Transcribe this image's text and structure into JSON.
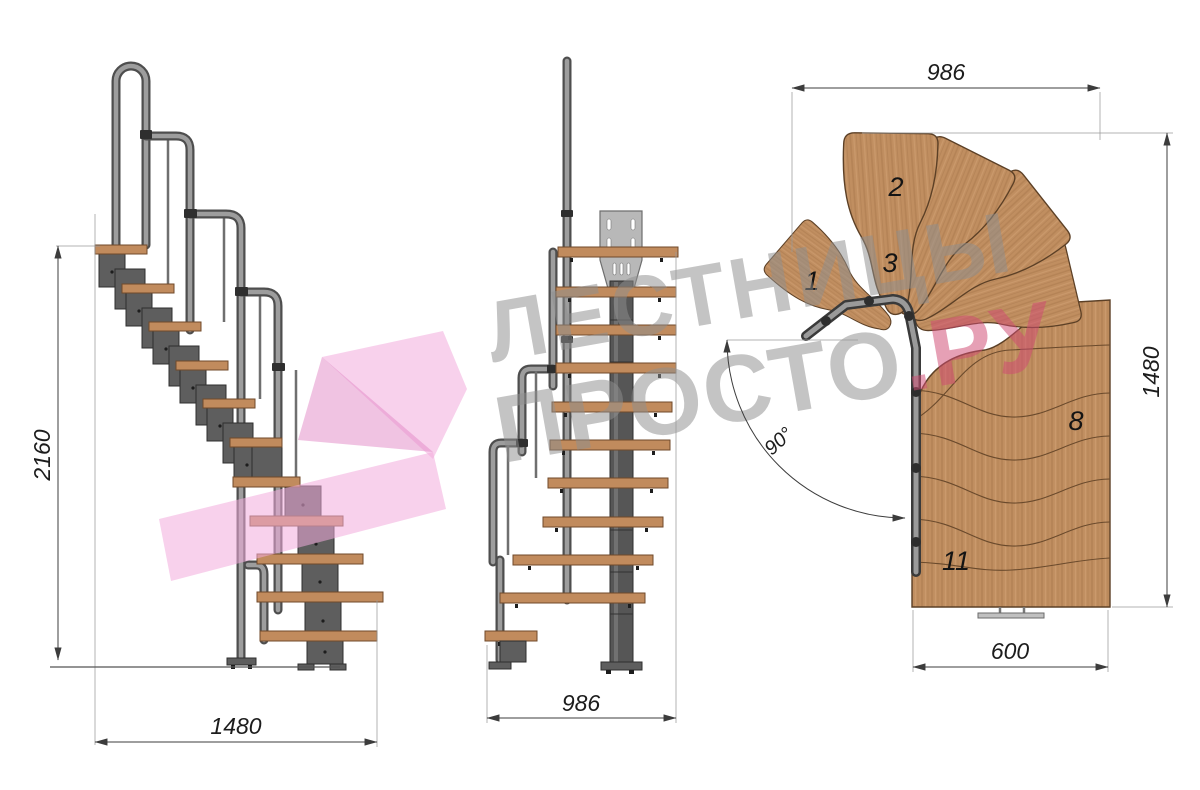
{
  "watermark": {
    "line1": "ЛЕСТНИЦЫ",
    "line2": "ПРОСТО",
    "line2_accent": ".РУ"
  },
  "side_view": {
    "height_mm": "2160",
    "run_mm": "1480"
  },
  "front_view": {
    "width_mm": "986"
  },
  "plan_view": {
    "width_top_mm": "986",
    "length_mm": "1480",
    "width_bottom_mm": "600",
    "turn_angle": "90°",
    "step_labels": [
      "1",
      "2",
      "3",
      "8",
      "11"
    ]
  },
  "colors": {
    "wood": "#c08e60",
    "metal": "#5e5e5e",
    "tube_gray": "#9d9d9d",
    "watermark_gray": "#8f8f8f",
    "watermark_pink": "#d04b73",
    "logo_pink": "#f3abdc"
  }
}
